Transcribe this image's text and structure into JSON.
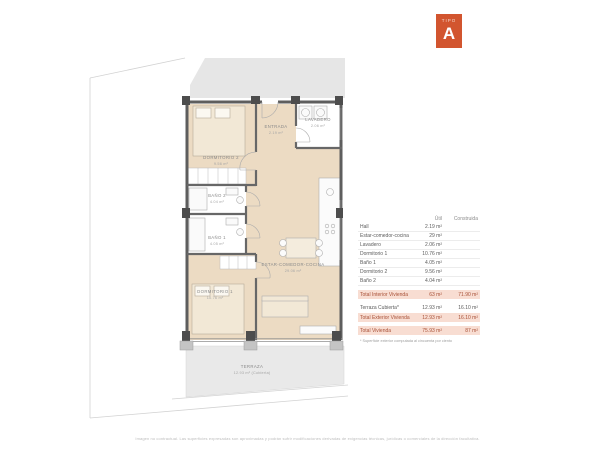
{
  "badge": {
    "kicker": "TIPO",
    "letter": "A",
    "color": "#d2552f"
  },
  "plan": {
    "rooms": [
      {
        "id": "dormitorio-2",
        "name": "DORMITORIO 2",
        "area": "9.56 m²"
      },
      {
        "id": "entrada",
        "name": "ENTRADA",
        "area": "2.19 m²"
      },
      {
        "id": "lavadero",
        "name": "LAVADERO",
        "area": "2.06 m²"
      },
      {
        "id": "bano-2",
        "name": "BAÑO 2",
        "area": "4.04 m²"
      },
      {
        "id": "bano-1",
        "name": "BAÑO 1",
        "area": "4.05 m²"
      },
      {
        "id": "dormitorio-1",
        "name": "DORMITORIO 1",
        "area": "10.76 m²"
      },
      {
        "id": "estar-comedor-cocina",
        "name": "ESTAR-COMEDOR-COCINA",
        "area": "29.06 m²"
      },
      {
        "id": "terraza",
        "name": "TERRAZA",
        "area": "12.93 m² (Cubierta)"
      }
    ]
  },
  "table": {
    "headers": {
      "util": "Útil",
      "construida": "Construida"
    },
    "rows": [
      {
        "label": "Hall",
        "util": "2.19 m²",
        "construida": ""
      },
      {
        "label": "Estar-comedor-cocina",
        "util": "29 m²",
        "construida": ""
      },
      {
        "label": "Lavadero",
        "util": "2.06 m²",
        "construida": ""
      },
      {
        "label": "Dormitorio 1",
        "util": "10.76 m²",
        "construida": ""
      },
      {
        "label": "Baño 1",
        "util": "4.05 m²",
        "construida": ""
      },
      {
        "label": "Dormitorio 2",
        "util": "9.56 m²",
        "construida": ""
      },
      {
        "label": "Baño 2",
        "util": "4.04 m²",
        "construida": ""
      }
    ],
    "totals": {
      "interior": {
        "label": "Total Interior Vivienda",
        "util": "63 m²",
        "construida": "71.90 m²"
      },
      "terraza": {
        "label": "Terraza Cubierta*",
        "util": "12.93 m²",
        "construida": "16.10 m²"
      },
      "exterior": {
        "label": "Total Exterior Vivienda",
        "util": "12.93 m²",
        "construida": "16.10 m²"
      },
      "vivienda": {
        "label": "Total Vivienda",
        "util": "75.93 m²",
        "construida": "87 m²"
      }
    },
    "footnote": "* Superficie exterior computada al cincuenta por ciento"
  },
  "footer": {
    "disclaimer": "Imagen no contractual. Las superficies expresadas son aproximadas y podrán sufrir modificaciones derivadas de exigencias técnicas, jurídicas o comerciales de la dirección facultativa."
  },
  "colors": {
    "accent": "#d2552f",
    "highlight": "#f8ddd2",
    "floor": "#ecdbc3",
    "wall": "#5e5e5e",
    "neighbor": "#e6e6e6",
    "terrace": "#e9e9e9"
  }
}
